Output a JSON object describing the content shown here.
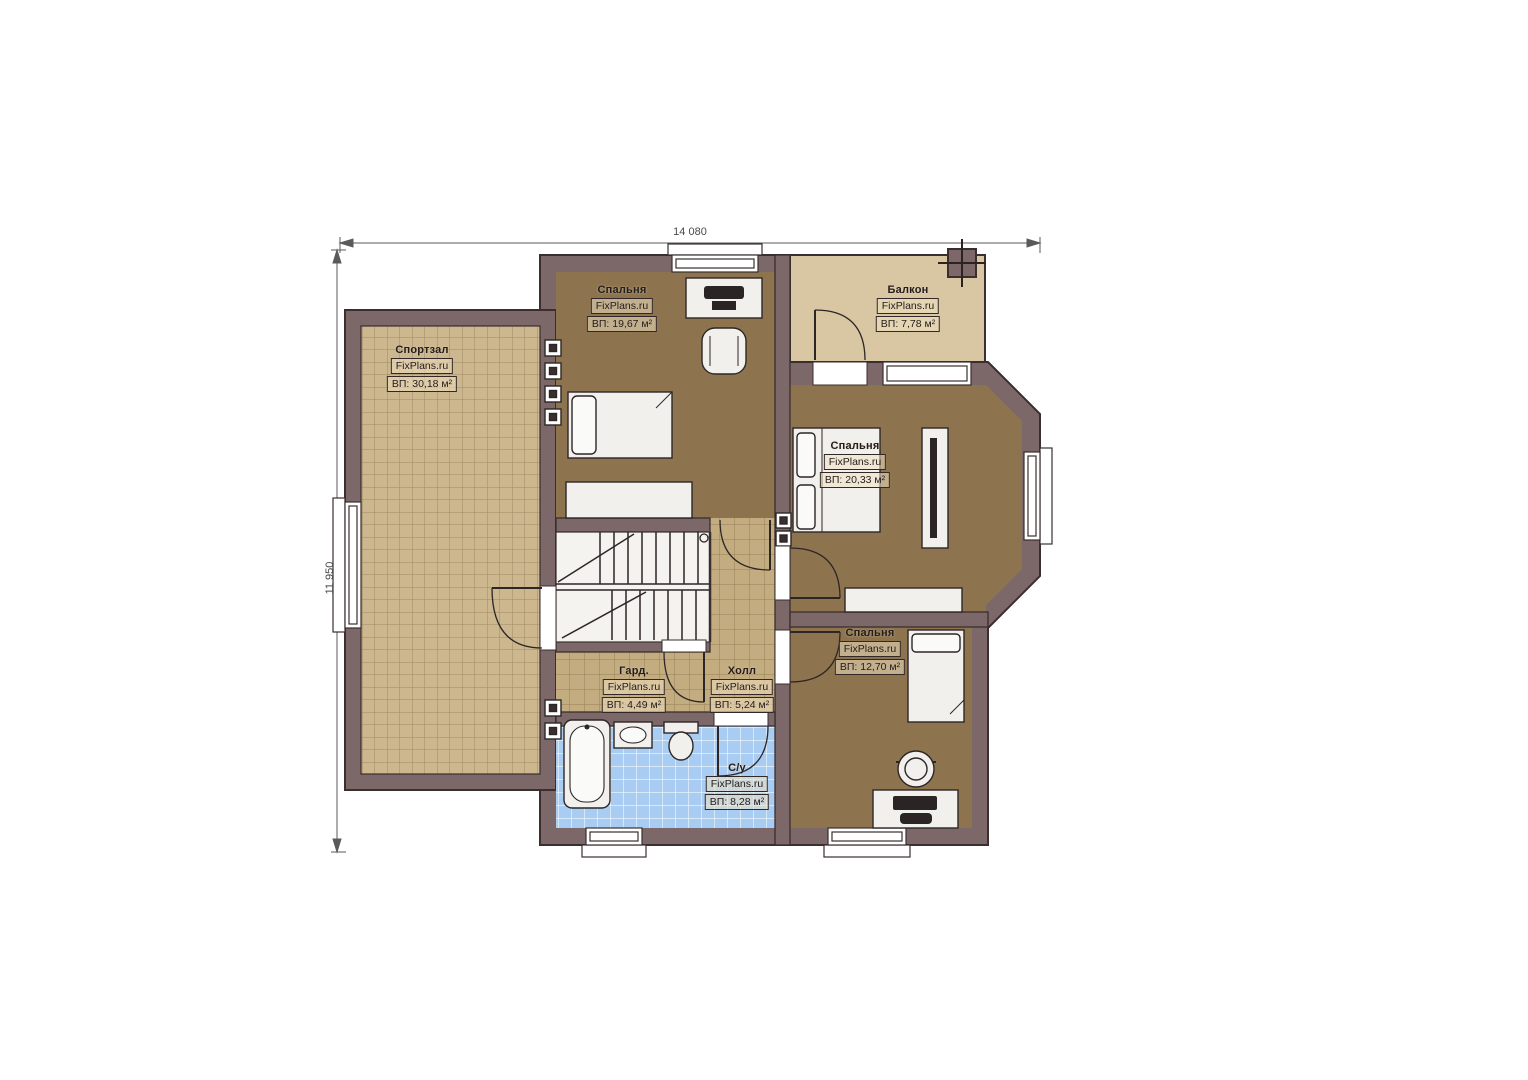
{
  "dimensions": {
    "horizontal": "14 080",
    "vertical": "11 950"
  },
  "rooms": [
    {
      "key": "gym",
      "name": "Спортзал",
      "brand": "FixPlans.ru",
      "area": "ВП: 30,18 м²"
    },
    {
      "key": "bedroom-top",
      "name": "Спальня",
      "brand": "FixPlans.ru",
      "area": "ВП: 19,67 м²"
    },
    {
      "key": "balcony",
      "name": "Балкон",
      "brand": "FixPlans.ru",
      "area": "ВП: 7,78 м²"
    },
    {
      "key": "bedroom-right",
      "name": "Спальня",
      "brand": "FixPlans.ru",
      "area": "ВП: 20,33 м²"
    },
    {
      "key": "bedroom-bottom",
      "name": "Спальня",
      "brand": "FixPlans.ru",
      "area": "ВП: 12,70 м²"
    },
    {
      "key": "wardrobe-room",
      "name": "Гард.",
      "brand": "FixPlans.ru",
      "area": "ВП: 4,49 м²"
    },
    {
      "key": "hall",
      "name": "Холл",
      "brand": "FixPlans.ru",
      "area": "ВП: 5,24 м²"
    },
    {
      "key": "bathroom",
      "name": "С/у",
      "brand": "FixPlans.ru",
      "area": "ВП: 8,28 м²"
    }
  ],
  "colors": {
    "wall": "#7c6869",
    "outline": "#3a2e2e",
    "gym_floor": "#ccb78e",
    "bedroom_floor": "#8d744f",
    "hall_floor": "#c3ac7f",
    "balcony_floor": "#d8c7a2",
    "bathroom_floor": "#a9cdf2",
    "furniture": "#f1f0ed"
  }
}
